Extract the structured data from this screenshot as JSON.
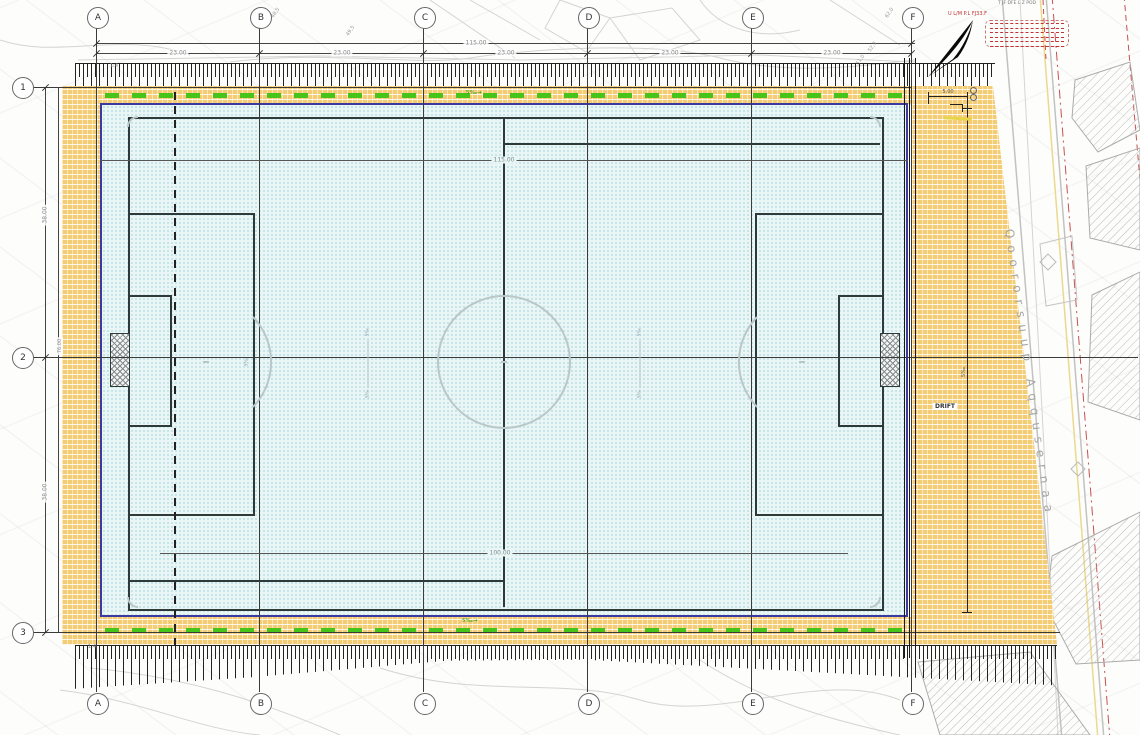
{
  "drawing": {
    "grid": {
      "columns": [
        "A",
        "B",
        "C",
        "D",
        "E",
        "F"
      ],
      "rows": [
        "1",
        "2",
        "3"
      ]
    },
    "dims": {
      "top_overall": "115.00",
      "seg1": "23.00",
      "seg2": "23.00",
      "seg3": "23.00",
      "seg4": "23.00",
      "seg5": "23.00",
      "left_seg1": "38.00",
      "left_seg2": "38.00",
      "left_overall": "76.00",
      "field_length": "115.00",
      "pitch_length": "100.00",
      "right_offset": "5.00"
    },
    "road": {
      "name": "Qoororsuup Aqqusernaa"
    },
    "ann": {
      "slope_arrow": "5‰→",
      "slope_mark": "5‰",
      "embankment": "1:4",
      "drift": "DRIFT",
      "elev1": "48,5",
      "elev2": "49,5",
      "elev3": "62,0",
      "elev4": "52,3",
      "elev5": "51,0"
    },
    "legend": {
      "title": "U L/M P.L FJ33.F",
      "note": "T JF DFE L Z POD"
    },
    "colors": {
      "field": "#eaf6f6",
      "kerb": "#3a3aa0",
      "gravel": "#f3cc74",
      "drain_green": "#46c41a",
      "red": "#c23333",
      "line_dark": "#2e3a3a"
    }
  }
}
